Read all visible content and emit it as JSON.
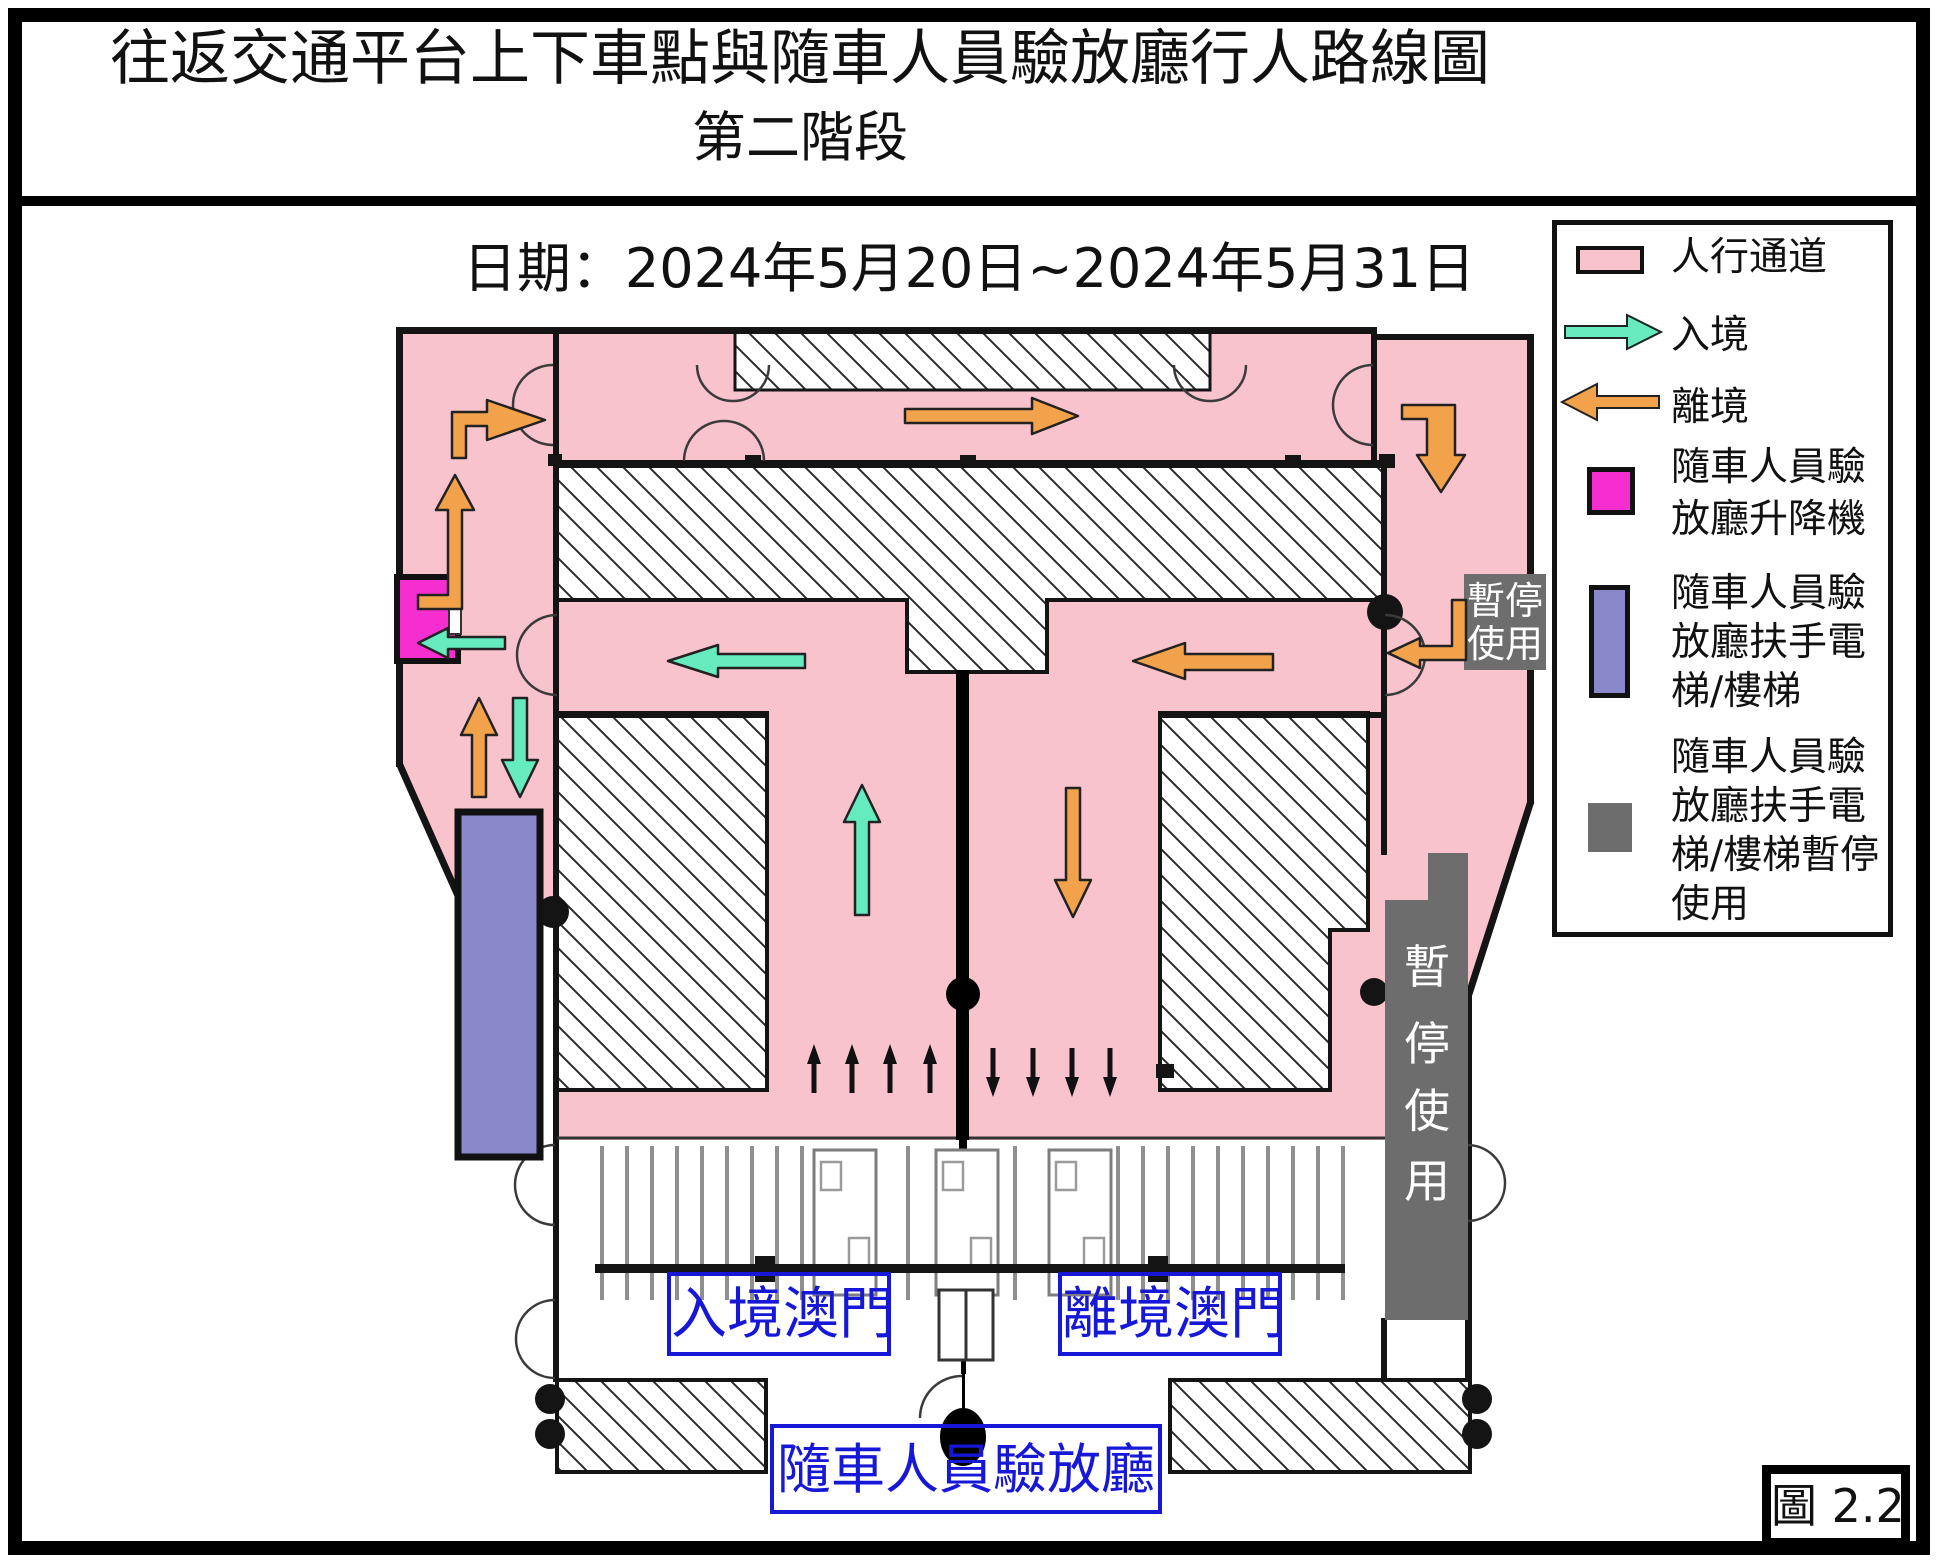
{
  "title": {
    "line1": "往返交通平台上下車點與隨車人員驗放廳行人路線圖",
    "line2": "第二階段"
  },
  "date_label": "日期：2024年5月20日~2024年5月31日",
  "legend": {
    "items": [
      {
        "icon": "pedestrian-walkway-swatch",
        "label": "人行通道",
        "color": "#f8c3cd"
      },
      {
        "icon": "arrival-arrow-icon",
        "label": "入境",
        "color": "#65ebbd"
      },
      {
        "icon": "departure-arrow-icon",
        "label": "離境",
        "color": "#f2a24b"
      },
      {
        "icon": "elevator-swatch",
        "lines": [
          "隨車人員驗",
          "放廳升降機"
        ],
        "color": "#f62ecf"
      },
      {
        "icon": "escalator-swatch",
        "lines": [
          "隨車人員驗",
          "放廳扶手電",
          "梯/樓梯"
        ],
        "color": "#8a87ca"
      },
      {
        "icon": "escalator-suspended-swatch",
        "lines": [
          "隨車人員驗",
          "放廳扶手電",
          "梯/樓梯暫停",
          "使用"
        ],
        "color": "#6d6d6d"
      }
    ]
  },
  "map_labels": {
    "suspended_box": {
      "line1": "暫停",
      "line2": "使用"
    },
    "suspended_vertical_chars": [
      "暫",
      "停",
      "使",
      "用"
    ],
    "arrival_macau": "入境澳門",
    "departure_macau": "離境澳門",
    "inspection_hall": "隨車人員驗放廳"
  },
  "figure_label": "圖 2.2",
  "colors": {
    "pedestrian_pink": "#f8c3cd",
    "arrival_green": "#65ebbd",
    "departure_orange": "#f2a24b",
    "elevator_magenta": "#f62ecf",
    "escalator_purple": "#8a87ca",
    "suspended_gray": "#6d6d6d",
    "label_blue": "#1717d8",
    "wall_black": "#141414"
  }
}
